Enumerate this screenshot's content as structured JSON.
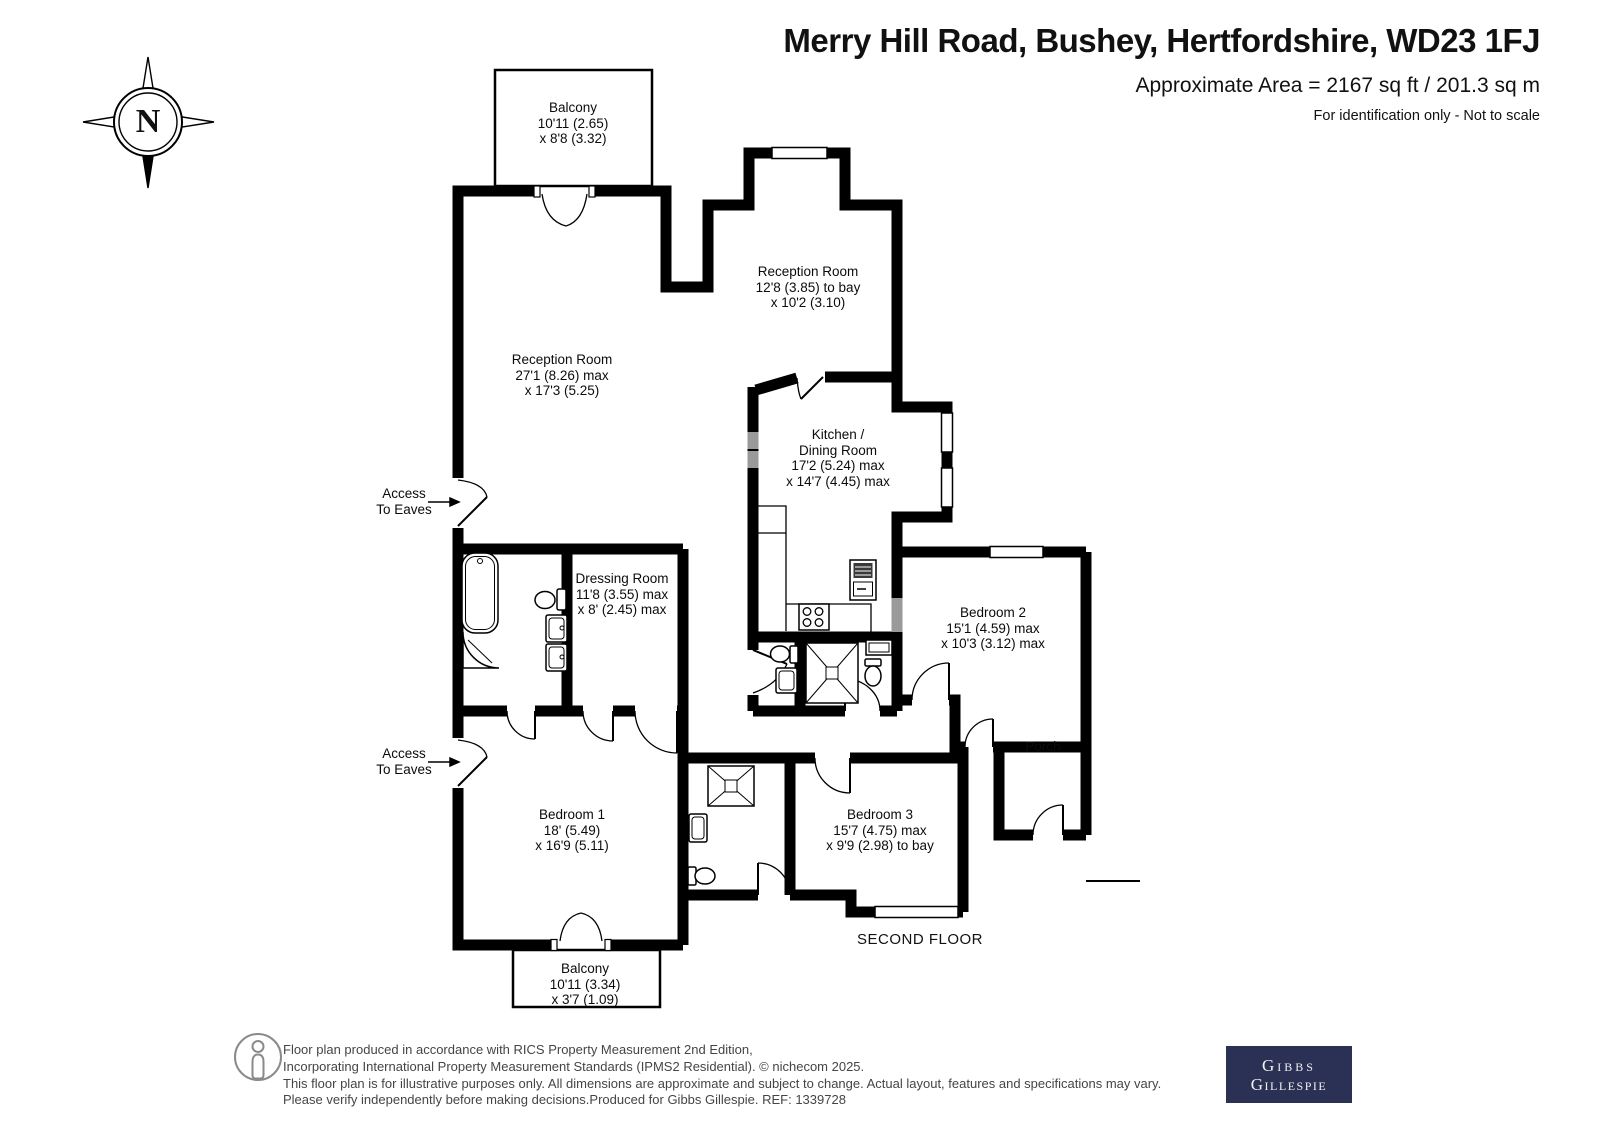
{
  "header": {
    "title": "Merry Hill Road, Bushey, Hertfordshire, WD23 1FJ",
    "area": "Approximate Area = 2167 sq ft / 201.3 sq m",
    "note": "For identification only - Not to scale"
  },
  "compass": {
    "north": "N"
  },
  "rooms": {
    "balcony_top": {
      "name": "Balcony",
      "d1": "10'11 (2.65)",
      "d2": "x 8'8 (3.32)"
    },
    "reception1": {
      "name": "Reception Room",
      "d1": "27'1 (8.26) max",
      "d2": "x 17'3 (5.25)"
    },
    "reception2": {
      "name": "Reception Room",
      "d1": "12'8 (3.85) to bay",
      "d2": "x 10'2 (3.10)"
    },
    "kitchen": {
      "name": "Kitchen /",
      "name2": "Dining Room",
      "d1": "17'2 (5.24) max",
      "d2": "x 14'7 (4.45) max"
    },
    "dressing": {
      "name": "Dressing Room",
      "d1": "11'8 (3.55) max",
      "d2": "x 8' (2.45) max"
    },
    "bedroom1": {
      "name": "Bedroom 1",
      "d1": "18' (5.49)",
      "d2": "x 16'9 (5.11)"
    },
    "bedroom2": {
      "name": "Bedroom 2",
      "d1": "15'1 (4.59) max",
      "d2": "x 10'3 (3.12) max"
    },
    "bedroom3": {
      "name": "Bedroom 3",
      "d1": "15'7 (4.75) max",
      "d2": "x 9'9 (2.98) to bay"
    },
    "porch": {
      "name": "Porch"
    },
    "balcony_bottom": {
      "name": "Balcony",
      "d1": "10'11 (3.34)",
      "d2": "x 3'7 (1.09)"
    }
  },
  "annotations": {
    "access1_l1": "Access",
    "access1_l2": "To Eaves",
    "access2_l1": "Access",
    "access2_l2": "To Eaves",
    "floor_label": "SECOND FLOOR"
  },
  "footer": {
    "line1": "Floor plan produced in accordance with RICS Property Measurement 2nd Edition,",
    "line2": "Incorporating International Property Measurement Standards (IPMS2 Residential).   © nichecom 2025.",
    "line3": "This floor plan is for illustrative purposes only. All dimensions are approximate and subject to change. Actual layout, features and specifications may vary.",
    "line4": "Please verify independently before making decisions.Produced for Gibbs Gillespie.   REF:   1339728"
  },
  "logo": {
    "line1": "Gibbs",
    "line2": "Gillespie",
    "bg": "#2a3154",
    "text_color": "#f2f2f2"
  },
  "colors": {
    "wall": "#000000",
    "window_gray": "#9a9a9a"
  }
}
